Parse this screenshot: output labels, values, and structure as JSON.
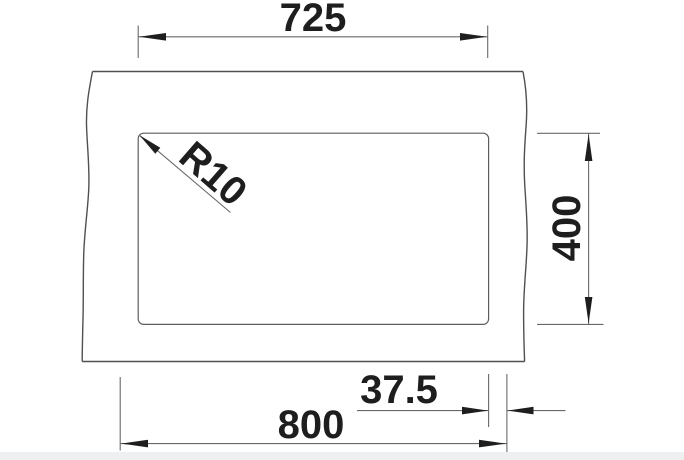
{
  "drawing": {
    "labels": {
      "bowl_width": "725",
      "bowl_depth": "400",
      "side_offset": "37.5",
      "overall_width": "800",
      "corner_radius": "R10"
    }
  },
  "colors": {
    "background": "#ffffff",
    "outline": "#4e5052",
    "dimension_lines": "#68696b",
    "arrows_and_text": "#1e1e1e",
    "footer_bar": "#edeff0"
  }
}
